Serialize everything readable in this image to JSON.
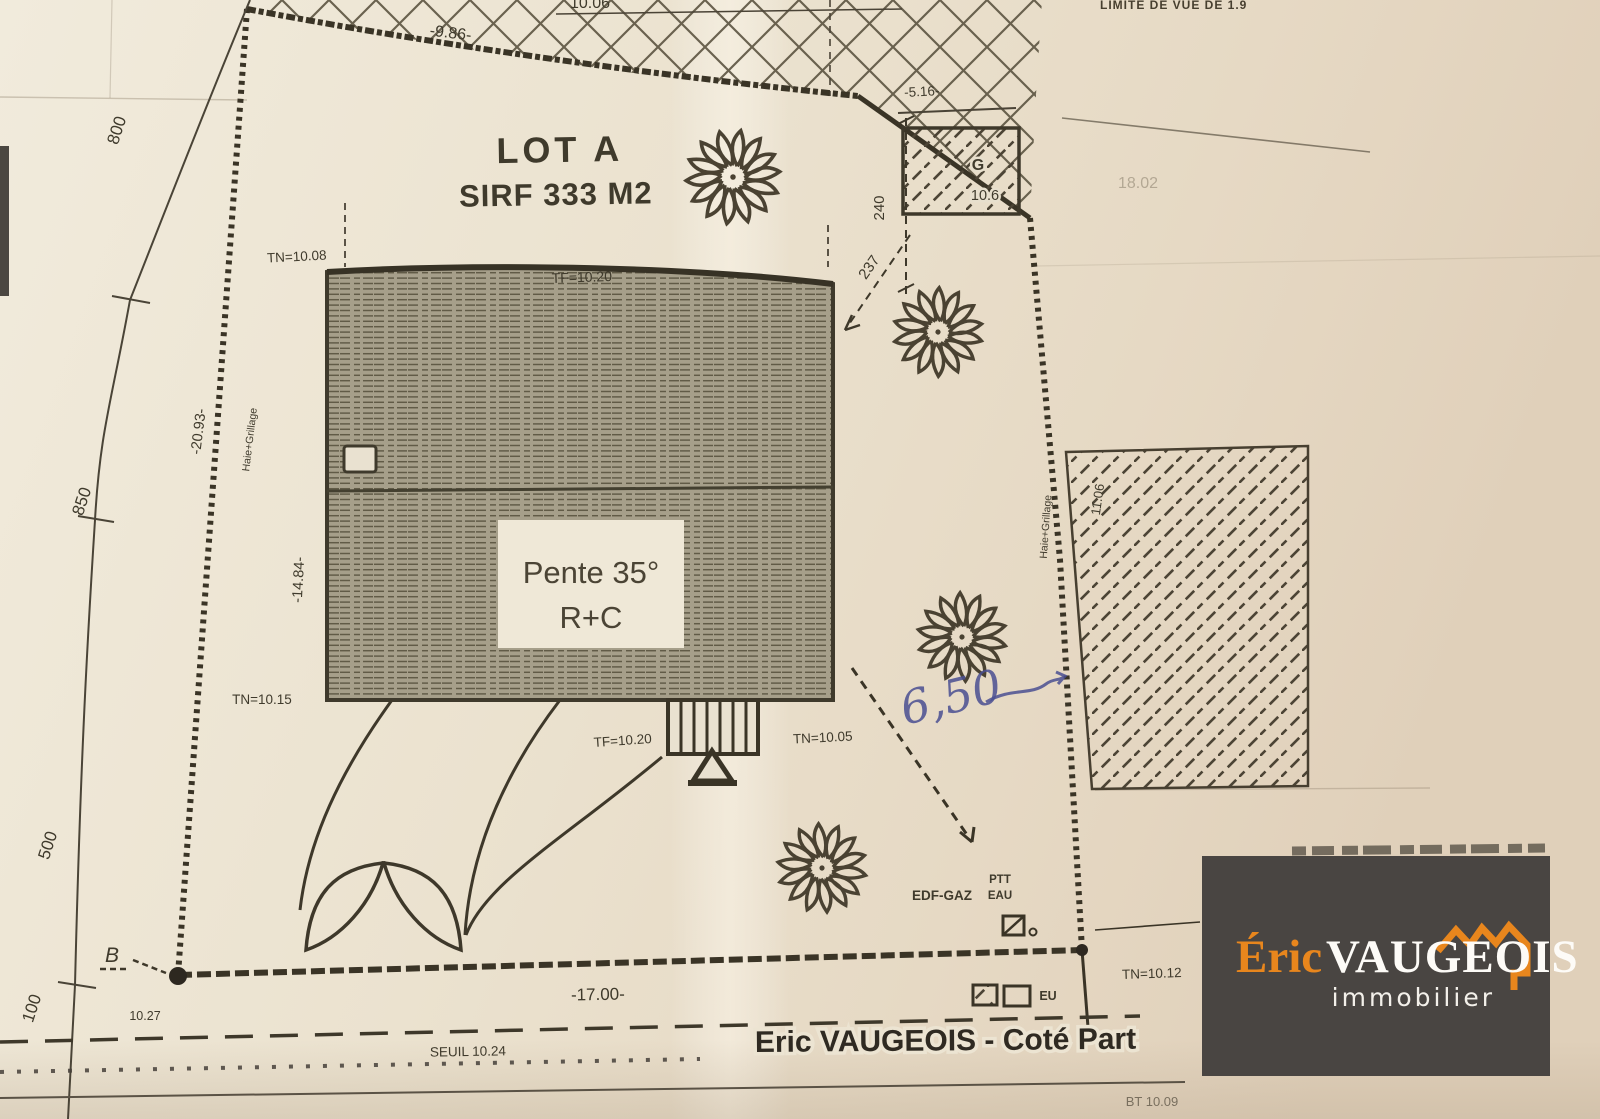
{
  "plan": {
    "lot": {
      "title": "LOT A",
      "surface": "SIRF 333 M2"
    },
    "house": {
      "roof_label_line1": "Pente 35°",
      "roof_label_line2": "R+C",
      "tf_top": "TF=10.20",
      "tf_bottom": "TF=10.20"
    },
    "levels": {
      "tn_nw": "TN=10.08",
      "tn_sw": "TN=10.15",
      "tn_se": "TN=10.05",
      "tn_east": "TN=10.12",
      "seuil": "SEUIL 10.24",
      "corner_point": "10.27",
      "bt": "BT 10.09"
    },
    "dimensions": {
      "top": "-9.86-",
      "top_cut": "10.06",
      "bottom": "-17.00-",
      "west_side": "-20.93-",
      "house_west": "-14.84-",
      "ne_width": "-5.16-",
      "ne_depth": "240",
      "ne_diag": "237",
      "east_side": "11.06",
      "handwritten_blue": "6,50"
    },
    "boundaries": {
      "hedge_west": "Haie+Grillage",
      "hedge_east": "Haie+Grillage",
      "limit_note": "LIMITE DE VUE DE 1.9",
      "faint_value": "18.02"
    },
    "garage": {
      "label": "G",
      "level": "10.6"
    },
    "stations": [
      "800",
      "850",
      "500",
      "100"
    ],
    "point_b": "B",
    "utilities": {
      "edf": "EDF-GAZ",
      "ptt": "PTT",
      "eau": "EAU",
      "eu": "EU"
    }
  },
  "footer": {
    "credit": "Eric VAUGEOIS - Coté Part"
  },
  "logo": {
    "accent_text": "Éric",
    "main_text": "VAUGEOIS",
    "tagline": "immobilier"
  },
  "colors": {
    "paper": "#ece3d2",
    "ink": "#3e382a",
    "accent_orange": "#e8861d",
    "logo_bg": "#494542",
    "hand_blue": "#4a4f92"
  }
}
